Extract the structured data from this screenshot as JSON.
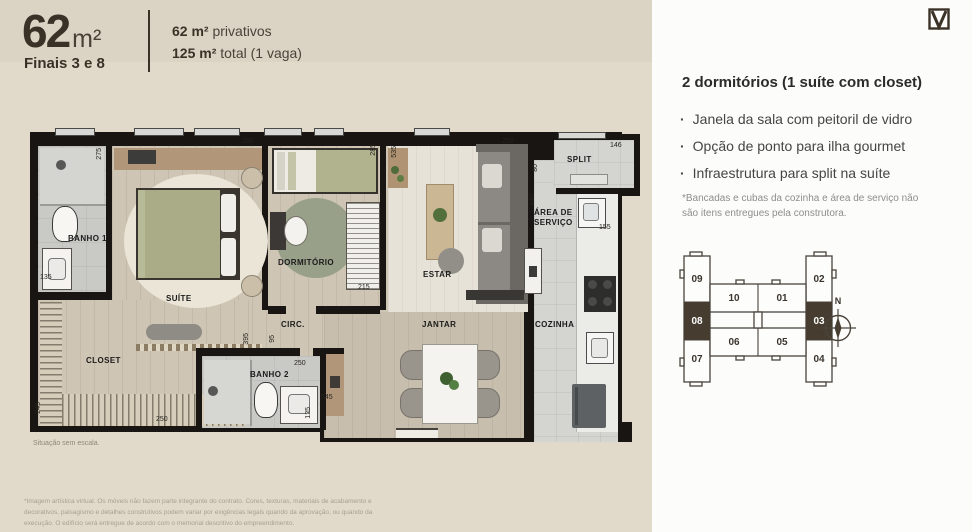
{
  "header": {
    "area_big": "62",
    "area_unit": "m²",
    "finais": "Finais 3 e 8",
    "line1_bold": "62 m²",
    "line1_rest": " privativos",
    "line2_bold": "125 m²",
    "line2_rest": " total (1 vaga)"
  },
  "logo_mark": "V",
  "details": {
    "title": "2 dormitórios (1 suíte com closet)",
    "bullets": [
      "Janela da sala com peitoril de vidro",
      "Opção de ponto para ilha gourmet",
      "Infraestrutura para split na suíte"
    ],
    "footnote": "*Bancadas e cubas da cozinha e área de serviço não são itens entregues pela construtora."
  },
  "keyplan": {
    "compass_label": "N",
    "units": [
      {
        "id": "09",
        "x": 8,
        "y": 22,
        "sel": false
      },
      {
        "id": "10",
        "x": 45,
        "y": 41,
        "sel": false
      },
      {
        "id": "01",
        "x": 93,
        "y": 41,
        "sel": false
      },
      {
        "id": "02",
        "x": 130,
        "y": 22,
        "sel": false
      },
      {
        "id": "08",
        "x": 8,
        "y": 52,
        "sel": true
      },
      {
        "id": "03",
        "x": 130,
        "y": 52,
        "sel": true
      },
      {
        "id": "07",
        "x": 8,
        "y": 102,
        "sel": false
      },
      {
        "id": "06",
        "x": 45,
        "y": 85,
        "sel": false
      },
      {
        "id": "05",
        "x": 93,
        "y": 85,
        "sel": false
      },
      {
        "id": "04",
        "x": 130,
        "y": 102,
        "sel": false
      }
    ]
  },
  "floorplan": {
    "scale_note": "Situação sem escala.",
    "rooms": [
      {
        "name": "BANHO 1",
        "x": 46,
        "y": 112
      },
      {
        "name": "SUÍTE",
        "x": 144,
        "y": 172
      },
      {
        "name": "CLOSET",
        "x": 64,
        "y": 234
      },
      {
        "name": "DORMITÓRIO",
        "x": 256,
        "y": 136
      },
      {
        "name": "CIRC.",
        "x": 259,
        "y": 198
      },
      {
        "name": "BANHO 2",
        "x": 228,
        "y": 248
      },
      {
        "name": "ESTAR",
        "x": 401,
        "y": 148
      },
      {
        "name": "JANTAR",
        "x": 400,
        "y": 198
      },
      {
        "name": "COZINHA",
        "x": 513,
        "y": 198
      },
      {
        "name": "SPLIT",
        "x": 545,
        "y": 33
      },
      {
        "name": "ÁREA DE",
        "x": 512,
        "y": 86
      },
      {
        "name": "SERVIÇO",
        "x": 512,
        "y": 96
      }
    ],
    "dims": [
      {
        "v": "275",
        "x": 74,
        "y": 26,
        "rot": true
      },
      {
        "v": "260",
        "x": 220,
        "y": 16,
        "rot": false
      },
      {
        "v": "285",
        "x": 348,
        "y": 22,
        "rot": true
      },
      {
        "v": "535",
        "x": 369,
        "y": 24,
        "rot": true
      },
      {
        "v": "250",
        "x": 480,
        "y": 16,
        "rot": false
      },
      {
        "v": "146",
        "x": 588,
        "y": 20,
        "rot": false
      },
      {
        "v": "80",
        "x": 510,
        "y": 42,
        "rot": true
      },
      {
        "v": "440",
        "x": 507,
        "y": 72,
        "rot": true
      },
      {
        "v": "155",
        "x": 577,
        "y": 102,
        "rot": false
      },
      {
        "v": "215",
        "x": 336,
        "y": 162,
        "rot": false
      },
      {
        "v": "135",
        "x": 18,
        "y": 152,
        "rot": false
      },
      {
        "v": "245",
        "x": 13,
        "y": 280,
        "rot": true
      },
      {
        "v": "250",
        "x": 134,
        "y": 294,
        "rot": false
      },
      {
        "v": "395",
        "x": 221,
        "y": 211,
        "rot": true
      },
      {
        "v": "95",
        "x": 247,
        "y": 213,
        "rot": true
      },
      {
        "v": "250",
        "x": 272,
        "y": 238,
        "rot": false
      },
      {
        "v": "545",
        "x": 299,
        "y": 272,
        "rot": false
      },
      {
        "v": "125",
        "x": 283,
        "y": 285,
        "rot": true
      }
    ]
  },
  "disclaimer": "*Imagem artística virtual. Os móveis não fazem parte integrante do contrato. Cores, texturas, materiais de acabamento e decorativos, paisagismo e detalhes construtivos podem variar por exigências legais quando da aprovação, ou quando da execução. O edifício será entregue de acordo com o memorial descritivo do empreendimento.",
  "colors": {
    "beige_header": "#dbd3c3",
    "beige_body": "#e1dacb",
    "brand_brown": "#3b3227",
    "wall_black": "#181512",
    "selected_unit": "#463c30"
  }
}
